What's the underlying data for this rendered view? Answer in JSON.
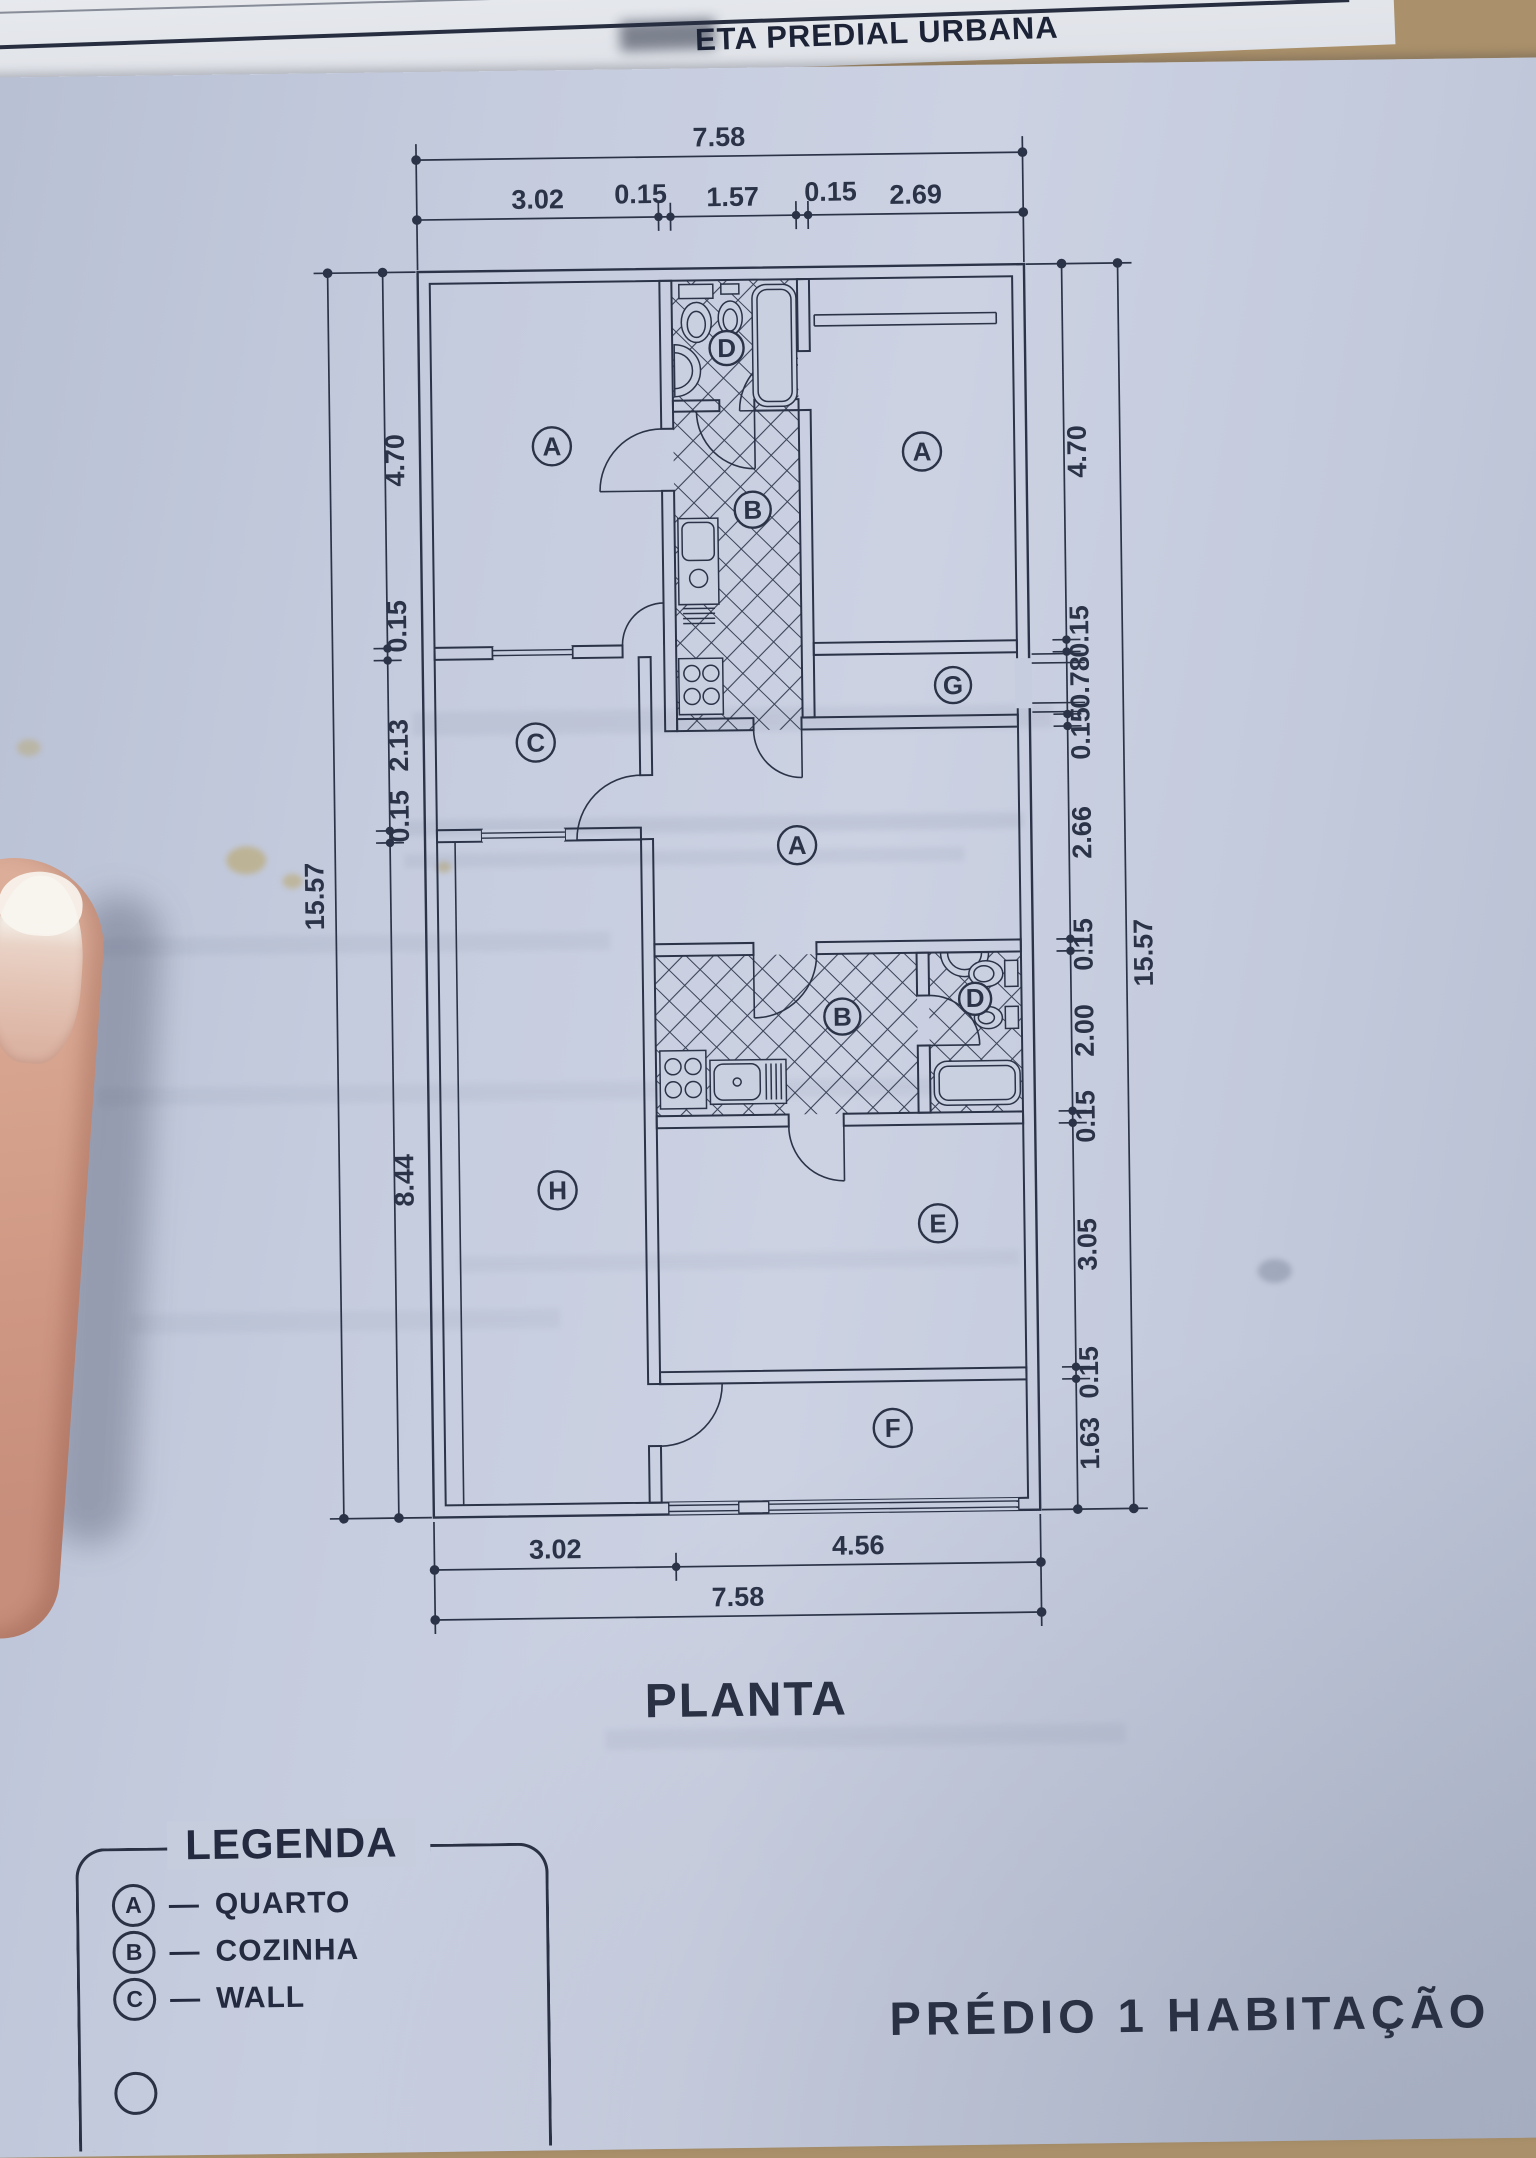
{
  "document": {
    "header_visible_text": "ETA PREDIAL URBANA",
    "plan_title": "PLANTA",
    "footer_clipped_text": "PRÉDIO 1  HABITAÇÃO"
  },
  "plan": {
    "rooms": {
      "top_left": "A",
      "bath_top": "D",
      "top_right": "A",
      "kitchen_top": "B",
      "corridor": "C",
      "hall": "G",
      "middle": "A",
      "kitchen_lower": "B",
      "bath_lower": "D",
      "yard": "H",
      "room_e": "E",
      "room_f": "F"
    },
    "dims": {
      "top_total": "7.58",
      "top_segments": [
        "3.02",
        "0.15",
        "1.57",
        "0.15",
        "2.69"
      ],
      "bottom_segments": [
        "3.02",
        "4.56"
      ],
      "bottom_total": "7.58",
      "left_total": "15.57",
      "left_segments": [
        "4.70",
        "0.15",
        "2.13",
        "0.15",
        "8.44"
      ],
      "right_segments": [
        "4.70",
        "0.15",
        "0.78",
        "0.15",
        "2.66",
        "0.15",
        "2.00",
        "0.15",
        "3.05",
        "0.15",
        "1.63"
      ],
      "right_total": "15.57"
    }
  },
  "legend": {
    "title": "LEGENDA",
    "separator": "—",
    "items": [
      {
        "key": "A",
        "label": "QUARTO"
      },
      {
        "key": "B",
        "label": "COZINHA"
      },
      {
        "key": "C",
        "label": "WALL"
      }
    ],
    "partial_fourth_circle": true
  },
  "colors": {
    "ink": "#2b3348",
    "paper": "#c6cdde"
  }
}
